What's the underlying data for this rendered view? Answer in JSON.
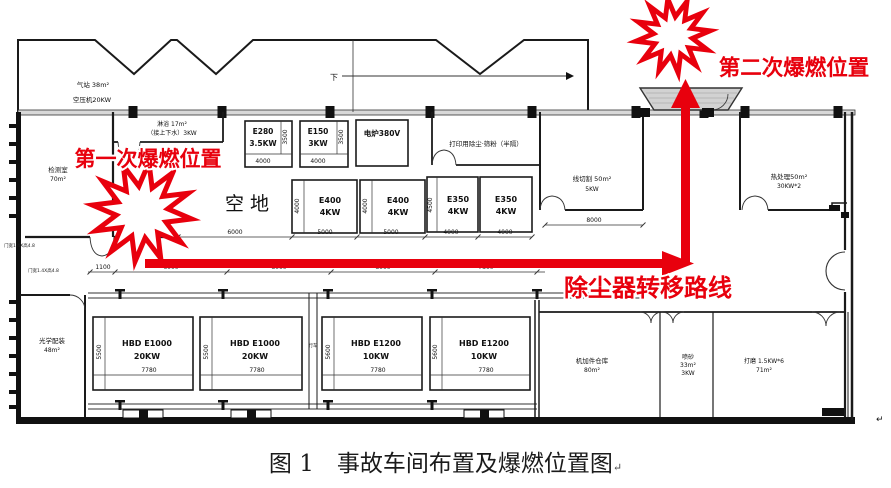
{
  "caption": {
    "text": "图 1　事故车间布置及爆燃位置图",
    "mark": "↵"
  },
  "annotations": {
    "first_explosion": "第一次爆燃位置",
    "second_explosion": "第二次爆燃位置",
    "route": "除尘器转移路线",
    "flow": "下",
    "page_mark": "↵"
  },
  "rooms": {
    "gas1": "气站 38m²",
    "gas2": "空压机20KW",
    "inspect1": "检测室",
    "inspect2": "70m²",
    "shower1": "淋浴 17m²",
    "shower2": "（接上下水）3KW",
    "open_area": "空地",
    "print_dust": "打印用除尘·筛粉（半隔）",
    "wire1": "线切割 50m²",
    "wire2": "5KW",
    "heat1": "热处理50m²",
    "heat2": "30KW*2",
    "optical1": "光学配装",
    "optical2": "48m²",
    "warehouse1": "机加件仓库",
    "warehouse2": "80m²",
    "sand1": "喷砂",
    "sand2": "33m²",
    "sand3": "3KW",
    "grind1": "打磨 1.5KW*6",
    "grind2": "71m²",
    "crane": "行车"
  },
  "machines_top": [
    {
      "name": "E280",
      "power": "3.5KW",
      "dim_w": "4000",
      "dim_h": "3500"
    },
    {
      "name": "E150",
      "power": "3KW",
      "dim_w": "4000",
      "dim_h": "3500"
    },
    {
      "name": "电炉380V"
    },
    {
      "name": "E400",
      "power": "4KW",
      "dim_w": "5000",
      "dim_h": "4000"
    },
    {
      "name": "E400",
      "power": "4KW",
      "dim_w": "5000",
      "dim_h": "4000"
    },
    {
      "name": "E350",
      "power": "4KW",
      "dim_w": "4000",
      "dim_h": "4500"
    },
    {
      "name": "E350",
      "power": "4KW",
      "dim_w": "4000"
    }
  ],
  "machines_bottom": [
    {
      "name": "HBD E1000",
      "power": "20KW",
      "dim_w": "7780",
      "dim_h": "5500"
    },
    {
      "name": "HBD E1000",
      "power": "20KW",
      "dim_w": "7780",
      "dim_h": "5500"
    },
    {
      "name": "HBD E1200",
      "power": "10KW",
      "dim_w": "7780",
      "dim_h": "5600"
    },
    {
      "name": "HBD E1200",
      "power": "10KW",
      "dim_w": "7780",
      "dim_h": "5600"
    }
  ],
  "dims": {
    "open_w": "6000",
    "wire_w": "8000",
    "row": [
      "1100",
      "6000",
      "8000",
      "8000",
      "7800"
    ]
  },
  "wall_notes": [
    "门宽1.4X高4.8",
    "门宽1.4X高4.8"
  ],
  "colors": {
    "annotation_red": "#e8000d",
    "wall_black": "#1a1a1a",
    "hatch_gray": "#d2d2d2"
  }
}
